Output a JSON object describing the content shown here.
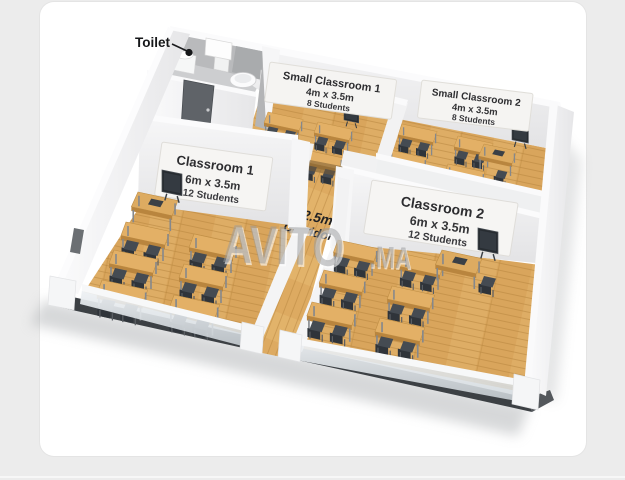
{
  "page": {
    "background": "#ececec",
    "card_background": "#ffffff"
  },
  "watermark": {
    "brand": "AVITO",
    "suffix": ".MA"
  },
  "plan": {
    "toilet": {
      "label": "Toilet"
    },
    "corridor": {
      "width": "2.5m",
      "label": "Corridor"
    },
    "rooms": {
      "small_classroom_1": {
        "name": "Small Classroom 1",
        "dimensions": "4m x 3.5m",
        "capacity": "8 Students"
      },
      "small_classroom_2": {
        "name": "Small Classroom 2",
        "dimensions": "4m x 3.5m",
        "capacity": "8 Students"
      },
      "classroom_1": {
        "name": "Classroom 1",
        "dimensions": "6m x 3.5m",
        "capacity": "12 Students"
      },
      "classroom_2": {
        "name": "Classroom 2",
        "dimensions": "6m x 3.5m",
        "capacity": "12 Students"
      }
    }
  },
  "colors": {
    "page_bg": "#ececec",
    "card_bg": "#ffffff",
    "wood": "#d9a55c",
    "wood_dark": "#b8863f",
    "wall": "#f3f3f4",
    "wall_shade": "#dededf",
    "toilet_wall": "#b9babc",
    "desk_wood": "#e3b066",
    "chair": "#34393f",
    "slab": "#3c4044",
    "label_text": "#2d2d30",
    "watermark_gray": "#97999c"
  }
}
